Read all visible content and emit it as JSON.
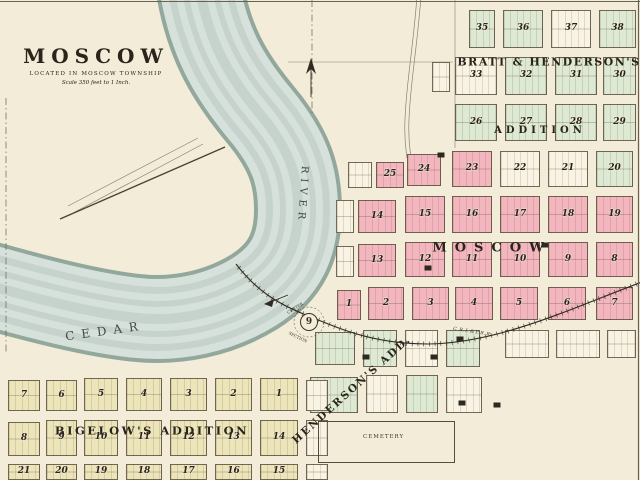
{
  "title": {
    "name": "MOSCOW",
    "subtitle": "LOCATED IN MOSCOW TOWNSHIP",
    "scale": "Scale 350 feet to 1 Inch."
  },
  "colors": {
    "paper": "#f3ecd9",
    "water": "#d7e1db",
    "water_band": "#c6d3cc",
    "bank": "#93a89d",
    "pink": "#f3b6bf",
    "green": "#dde9d2",
    "cream": "#ede5ba",
    "blockwhite": "#f8f3e3",
    "ink": "#2a241b",
    "line": "#6b6152"
  },
  "headings": {
    "bratt1": "BRATT & HENDERSON'S",
    "bratt2": "ADDITION",
    "moscow": "MOSCOW",
    "bigelow": "BIGELOW'S ADDITION",
    "henderson": "HENDERSON'S ADD."
  },
  "river": {
    "word1": "CEDAR",
    "word2": "RIVER"
  },
  "cemetery": {
    "label": "CEMETERY"
  },
  "railroad": {
    "label": "C. R. I. & P. R. R."
  },
  "section_marker": {
    "number": "9",
    "top": "CENTER",
    "bottom": "SECTION"
  },
  "streets_h": [
    {
      "n": "JACKSON",
      "x": 513,
      "y": 3,
      "st": "ST.",
      "sx": 600
    },
    {
      "n": "FREMONT",
      "x": 519,
      "y": 49,
      "st": "ST.",
      "sx": 564
    },
    {
      "n": "DES MOINES",
      "x": 519,
      "y": 96,
      "st": "ST.",
      "sx": 564
    },
    {
      "n": "BUCHANAN",
      "x": 513,
      "y": 143,
      "st": "ST.",
      "sx": 564
    },
    {
      "n": "CLAY",
      "x": 462,
      "y": 189,
      "st": "ST.",
      "sx": 566
    },
    {
      "n": "WASHINGTON",
      "x": 427,
      "y": 236,
      "st": "ST.",
      "sx": 566
    },
    {
      "n": "CEDAR",
      "x": 418,
      "y": 280,
      "st": "ST.",
      "sx": 560
    },
    {
      "n": "DAVENPORT",
      "x": 426,
      "y": 321,
      "st": "ST.",
      "sx": 550
    },
    {
      "n": "FRONT",
      "x": 52,
      "y": 370,
      "st": "ST.",
      "sx": 160
    },
    {
      "n": "SECOND",
      "x": 55,
      "y": 416,
      "st": "ST.",
      "sx": 233
    },
    {
      "n": "THIRD",
      "x": 55,
      "y": 458,
      "st": "ST.",
      "sx": 235
    },
    {
      "n": "",
      "x": 0,
      "y": 370,
      "st": "ST.",
      "sx": 376
    },
    {
      "n": "",
      "x": 0,
      "y": 415,
      "st": "ST.",
      "sx": 358
    }
  ],
  "streets_v": [
    {
      "n": "FIFTH",
      "x": 495,
      "y": 258
    },
    {
      "n": "SIXTH",
      "x": 543,
      "y": 258
    },
    {
      "n": "SEVENTH",
      "x": 591,
      "y": 260
    },
    {
      "n": "EIGHTH",
      "x": 635,
      "y": 258
    },
    {
      "n": "SECOND",
      "x": 362,
      "y": 390
    },
    {
      "n": "THIRD",
      "x": 402,
      "y": 392
    },
    {
      "n": "FOURTH",
      "x": 443,
      "y": 392
    },
    {
      "n": "CHERRY",
      "x": 43,
      "y": 438
    },
    {
      "n": "SPRUCE",
      "x": 80,
      "y": 438
    },
    {
      "n": "ELM",
      "x": 122,
      "y": 438
    },
    {
      "n": "CYPRESS",
      "x": 164,
      "y": 438
    },
    {
      "n": "CEDAR",
      "x": 211,
      "y": 438
    },
    {
      "n": "PINE",
      "x": 256,
      "y": 438
    },
    {
      "n": "OAK",
      "x": 302,
      "y": 438
    },
    {
      "n": "ST.",
      "x": 355,
      "y": 212
    },
    {
      "n": "ST.",
      "x": 310,
      "y": 384
    },
    {
      "n": "ST.",
      "x": 501,
      "y": 76
    },
    {
      "n": "ST.",
      "x": 551,
      "y": 76
    },
    {
      "n": "ST.",
      "x": 43,
      "y": 393
    },
    {
      "n": "ST.",
      "x": 122,
      "y": 393
    },
    {
      "n": "ST.",
      "x": 211,
      "y": 393
    },
    {
      "n": "ST.",
      "x": 302,
      "y": 393
    }
  ],
  "labels": [
    {
      "t": "Thos. Brown",
      "x": 32,
      "y": 250,
      "s": 5.5,
      "i": 1
    },
    {
      "t": "(3)",
      "x": 353,
      "y": 22,
      "s": 5
    },
    {
      "t": "C.F. Lange",
      "x": 341,
      "y": 33,
      "s": 5.5,
      "i": 1
    },
    {
      "t": "26 a.",
      "x": 355,
      "y": 45,
      "s": 5,
      "i": 1
    },
    {
      "t": "Wilson Pyberger",
      "x": 344,
      "y": 110,
      "s": 5.5,
      "i": 1
    },
    {
      "t": "7 a.",
      "x": 342,
      "y": 120,
      "s": 4.5,
      "i": 1
    },
    {
      "t": "7 a.",
      "x": 444,
      "y": 110,
      "s": 4.5,
      "i": 1
    },
    {
      "t": "Wilson Pyberger",
      "x": 442,
      "y": 123,
      "s": 5.5,
      "i": 1
    },
    {
      "t": "Res.",
      "x": 444,
      "y": 148,
      "s": 4.5
    },
    {
      "t": "W. Pyberger",
      "x": 366,
      "y": 186,
      "s": 4.5,
      "i": 1
    },
    {
      "t": "Road Travelled not open",
      "x": 133,
      "y": 172,
      "s": 4.5,
      "r": -26,
      "i": 1
    },
    {
      "t": "J.B. Heinley Mill Co.",
      "x": 33,
      "y": 358,
      "s": 4.5
    },
    {
      "t": "Lot 3",
      "x": 278,
      "y": 348,
      "s": 5,
      "i": 1
    },
    {
      "t": "Chas. Henderson's Heirs",
      "x": 352,
      "y": 467,
      "s": 5.5,
      "i": 1
    },
    {
      "t": "Chas. Henderson's Heirs",
      "x": 520,
      "y": 432,
      "s": 5.5,
      "i": 1
    },
    {
      "t": "Church",
      "x": 371,
      "y": 366,
      "s": 3.8
    },
    {
      "t": "F",
      "x": 40,
      "y": 473,
      "s": 4.5,
      "i": 1
    },
    {
      "t": "E",
      "x": 79,
      "y": 473,
      "s": 4.5,
      "i": 1
    },
    {
      "t": "D",
      "x": 122,
      "y": 474,
      "s": 4.5,
      "i": 1
    },
    {
      "t": "C",
      "x": 174,
      "y": 474,
      "s": 4.5,
      "i": 1
    },
    {
      "t": "B",
      "x": 212,
      "y": 474,
      "s": 4.5,
      "i": 1
    },
    {
      "t": "A",
      "x": 256,
      "y": 474,
      "s": 4.5,
      "i": 1
    }
  ],
  "buildings": [
    {
      "x": 441,
      "y": 155
    },
    {
      "x": 545,
      "y": 245
    },
    {
      "x": 428,
      "y": 268
    },
    {
      "x": 366,
      "y": 357
    },
    {
      "x": 434,
      "y": 357
    },
    {
      "x": 460,
      "y": 339
    },
    {
      "x": 462,
      "y": 403
    },
    {
      "x": 497,
      "y": 405
    }
  ],
  "blocks": [
    {
      "n": "35",
      "x": 469,
      "y": 10,
      "w": 26,
      "h": 38,
      "c": "g"
    },
    {
      "n": "36",
      "x": 503,
      "y": 10,
      "w": 40,
      "h": 38,
      "c": "g"
    },
    {
      "n": "37",
      "x": 551,
      "y": 10,
      "w": 40,
      "h": 38,
      "c": "w"
    },
    {
      "n": "38",
      "x": 599,
      "y": 10,
      "w": 37,
      "h": 38,
      "c": "g"
    },
    {
      "n": "33",
      "x": 455,
      "y": 57,
      "w": 42,
      "h": 38,
      "c": "w"
    },
    {
      "n": "32",
      "x": 505,
      "y": 57,
      "w": 42,
      "h": 38,
      "c": "g"
    },
    {
      "n": "31",
      "x": 555,
      "y": 57,
      "w": 42,
      "h": 38,
      "c": "g"
    },
    {
      "n": "30",
      "x": 603,
      "y": 57,
      "w": 33,
      "h": 38,
      "c": "g"
    },
    {
      "x": 432,
      "y": 62,
      "w": 18,
      "h": 30,
      "c": "w"
    },
    {
      "n": "26",
      "x": 455,
      "y": 104,
      "w": 42,
      "h": 37,
      "c": "g"
    },
    {
      "n": "27",
      "x": 505,
      "y": 104,
      "w": 42,
      "h": 37,
      "c": "g"
    },
    {
      "n": "28",
      "x": 555,
      "y": 104,
      "w": 42,
      "h": 37,
      "c": "g"
    },
    {
      "n": "29",
      "x": 603,
      "y": 104,
      "w": 33,
      "h": 37,
      "c": "g"
    },
    {
      "x": 348,
      "y": 162,
      "w": 24,
      "h": 26,
      "c": "w"
    },
    {
      "n": "25",
      "x": 376,
      "y": 162,
      "w": 28,
      "h": 26,
      "c": "p"
    },
    {
      "n": "24",
      "x": 407,
      "y": 154,
      "w": 34,
      "h": 32,
      "c": "p"
    },
    {
      "n": "23",
      "x": 452,
      "y": 151,
      "w": 40,
      "h": 36,
      "c": "p"
    },
    {
      "n": "22",
      "x": 500,
      "y": 151,
      "w": 40,
      "h": 36,
      "c": "w"
    },
    {
      "n": "21",
      "x": 548,
      "y": 151,
      "w": 40,
      "h": 36,
      "c": "w"
    },
    {
      "n": "20",
      "x": 596,
      "y": 151,
      "w": 37,
      "h": 36,
      "c": "g"
    },
    {
      "x": 336,
      "y": 200,
      "w": 18,
      "h": 33,
      "c": "w"
    },
    {
      "n": "14",
      "x": 358,
      "y": 200,
      "w": 38,
      "h": 33,
      "c": "p"
    },
    {
      "n": "15",
      "x": 405,
      "y": 196,
      "w": 40,
      "h": 37,
      "c": "p"
    },
    {
      "n": "16",
      "x": 452,
      "y": 196,
      "w": 40,
      "h": 37,
      "c": "p"
    },
    {
      "n": "17",
      "x": 500,
      "y": 196,
      "w": 40,
      "h": 37,
      "c": "p"
    },
    {
      "n": "18",
      "x": 548,
      "y": 196,
      "w": 40,
      "h": 37,
      "c": "p"
    },
    {
      "n": "19",
      "x": 596,
      "y": 196,
      "w": 37,
      "h": 37,
      "c": "p"
    },
    {
      "x": 336,
      "y": 246,
      "w": 18,
      "h": 31,
      "c": "w"
    },
    {
      "n": "13",
      "x": 358,
      "y": 244,
      "w": 38,
      "h": 33,
      "c": "p"
    },
    {
      "n": "12",
      "x": 405,
      "y": 242,
      "w": 40,
      "h": 35,
      "c": "p"
    },
    {
      "n": "11",
      "x": 452,
      "y": 242,
      "w": 40,
      "h": 35,
      "c": "p"
    },
    {
      "n": "10",
      "x": 500,
      "y": 242,
      "w": 40,
      "h": 35,
      "c": "p"
    },
    {
      "n": "9",
      "x": 548,
      "y": 242,
      "w": 40,
      "h": 35,
      "c": "p"
    },
    {
      "n": "8",
      "x": 596,
      "y": 242,
      "w": 37,
      "h": 35,
      "c": "p"
    },
    {
      "n": "1",
      "x": 337,
      "y": 290,
      "w": 24,
      "h": 30,
      "c": "p"
    },
    {
      "n": "2",
      "x": 368,
      "y": 287,
      "w": 36,
      "h": 33,
      "c": "p"
    },
    {
      "n": "3",
      "x": 412,
      "y": 287,
      "w": 37,
      "h": 33,
      "c": "p"
    },
    {
      "n": "4",
      "x": 455,
      "y": 287,
      "w": 38,
      "h": 33,
      "c": "p"
    },
    {
      "n": "5",
      "x": 500,
      "y": 287,
      "w": 38,
      "h": 33,
      "c": "p"
    },
    {
      "n": "6",
      "x": 548,
      "y": 287,
      "w": 38,
      "h": 33,
      "c": "p"
    },
    {
      "n": "7",
      "x": 596,
      "y": 287,
      "w": 37,
      "h": 33,
      "c": "p"
    },
    {
      "x": 315,
      "y": 332,
      "w": 40,
      "h": 33,
      "c": "g"
    },
    {
      "x": 363,
      "y": 330,
      "w": 34,
      "h": 37,
      "c": "g"
    },
    {
      "x": 405,
      "y": 330,
      "w": 33,
      "h": 37,
      "c": "w"
    },
    {
      "x": 446,
      "y": 330,
      "w": 34,
      "h": 37,
      "c": "g"
    },
    {
      "x": 505,
      "y": 330,
      "w": 44,
      "h": 28,
      "c": "w"
    },
    {
      "x": 556,
      "y": 330,
      "w": 44,
      "h": 28,
      "c": "w"
    },
    {
      "x": 607,
      "y": 330,
      "w": 29,
      "h": 28,
      "c": "w"
    },
    {
      "x": 310,
      "y": 377,
      "w": 48,
      "h": 36,
      "c": "g"
    },
    {
      "x": 366,
      "y": 375,
      "w": 32,
      "h": 38,
      "c": "w"
    },
    {
      "x": 406,
      "y": 375,
      "w": 32,
      "h": 38,
      "c": "g"
    },
    {
      "x": 446,
      "y": 377,
      "w": 36,
      "h": 36,
      "c": "w"
    },
    {
      "n": "7",
      "x": 8,
      "y": 380,
      "w": 32,
      "h": 31,
      "c": "c"
    },
    {
      "n": "6",
      "x": 46,
      "y": 380,
      "w": 31,
      "h": 31,
      "c": "c"
    },
    {
      "n": "5",
      "x": 84,
      "y": 378,
      "w": 34,
      "h": 33,
      "c": "c"
    },
    {
      "n": "4",
      "x": 126,
      "y": 378,
      "w": 36,
      "h": 33,
      "c": "c"
    },
    {
      "n": "3",
      "x": 170,
      "y": 378,
      "w": 37,
      "h": 33,
      "c": "c"
    },
    {
      "n": "2",
      "x": 215,
      "y": 378,
      "w": 37,
      "h": 33,
      "c": "c"
    },
    {
      "n": "1",
      "x": 260,
      "y": 378,
      "w": 38,
      "h": 33,
      "c": "c"
    },
    {
      "x": 306,
      "y": 380,
      "w": 22,
      "h": 31,
      "c": "w"
    },
    {
      "n": "8",
      "x": 8,
      "y": 422,
      "w": 32,
      "h": 34,
      "c": "c"
    },
    {
      "n": "9",
      "x": 46,
      "y": 420,
      "w": 31,
      "h": 36,
      "c": "c"
    },
    {
      "n": "10",
      "x": 84,
      "y": 420,
      "w": 34,
      "h": 36,
      "c": "c"
    },
    {
      "n": "11",
      "x": 126,
      "y": 420,
      "w": 36,
      "h": 36,
      "c": "c"
    },
    {
      "n": "12",
      "x": 170,
      "y": 420,
      "w": 37,
      "h": 36,
      "c": "c"
    },
    {
      "n": "13",
      "x": 215,
      "y": 420,
      "w": 37,
      "h": 36,
      "c": "c"
    },
    {
      "n": "14",
      "x": 260,
      "y": 420,
      "w": 38,
      "h": 36,
      "c": "c"
    },
    {
      "x": 306,
      "y": 420,
      "w": 22,
      "h": 36,
      "c": "w"
    },
    {
      "n": "21",
      "x": 8,
      "y": 464,
      "w": 32,
      "h": 16,
      "c": "c"
    },
    {
      "n": "20",
      "x": 46,
      "y": 464,
      "w": 31,
      "h": 16,
      "c": "c"
    },
    {
      "n": "19",
      "x": 84,
      "y": 464,
      "w": 34,
      "h": 16,
      "c": "c"
    },
    {
      "n": "18",
      "x": 126,
      "y": 464,
      "w": 36,
      "h": 16,
      "c": "c"
    },
    {
      "n": "17",
      "x": 170,
      "y": 464,
      "w": 37,
      "h": 16,
      "c": "c"
    },
    {
      "n": "16",
      "x": 215,
      "y": 464,
      "w": 37,
      "h": 16,
      "c": "c"
    },
    {
      "n": "15",
      "x": 260,
      "y": 464,
      "w": 38,
      "h": 16,
      "c": "c"
    },
    {
      "x": 306,
      "y": 464,
      "w": 22,
      "h": 16,
      "c": "w"
    }
  ]
}
